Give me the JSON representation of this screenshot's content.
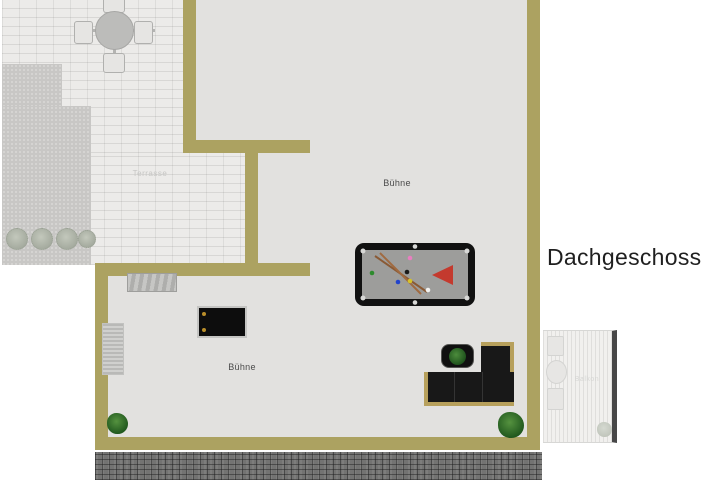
{
  "title": "Dachgeschoss",
  "labels": {
    "stage_upper": "Bühne",
    "stage_lower": "Bühne",
    "terrace": "Terrasse",
    "balcony": "Balkon"
  },
  "colors": {
    "wall": "#aca261",
    "interior_floor": "#e2e1df",
    "terrace_tile": "#ecebe9",
    "gravel_area": "#c8c7c5",
    "roof_tiles": "#737372",
    "balcony_deck": "#f1f0ee",
    "sofa_body": "#181818",
    "sofa_trim": "#b7a05c",
    "pool_table_frame": "#111111",
    "pool_felt": "#9d9d9b",
    "rack_triangle": "#c43a2e",
    "cue_brown": "#8a5a35",
    "plant_green": "#2e6b28"
  },
  "objects": [
    "terrace-dining-set",
    "shrub-row",
    "terrace-tiles",
    "gravel-area",
    "sideboard",
    "stair-mat",
    "black-table",
    "pool-table",
    "billiard-cues",
    "billiard-balls",
    "rack-triangle",
    "corner-sofa",
    "coffee-table-with-plant",
    "potted-plant-left",
    "potted-plant-right",
    "balcony-deck",
    "balcony-seating",
    "balcony-plant",
    "roof-tile-band"
  ]
}
